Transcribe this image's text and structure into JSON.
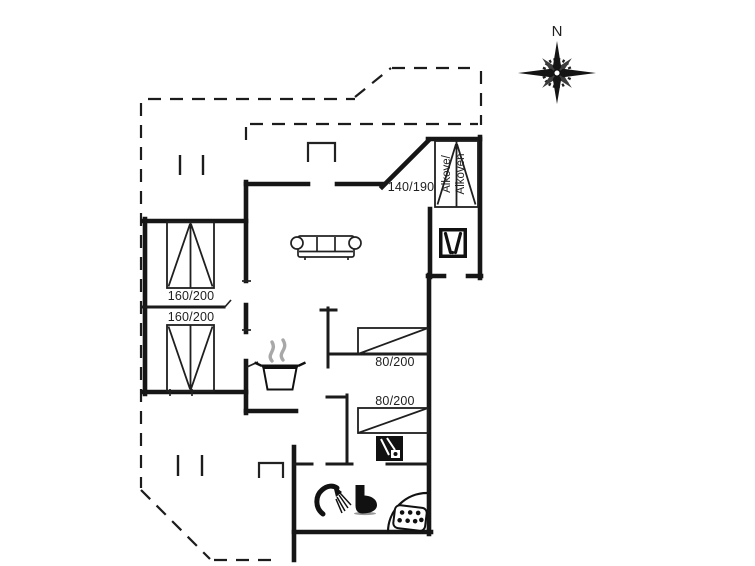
{
  "page": {
    "kind": "holiday-house floor plan drawing",
    "background": "#ffffff"
  },
  "compass": {
    "label": "N"
  },
  "rooms": {
    "bedroom_left_top": {
      "bed_label": "160/200"
    },
    "bedroom_left_bottom": {
      "bed_label": "160/200"
    },
    "alcove": {
      "bed_label": "140/190",
      "name_line1": "Alkove/",
      "name_line2": "Alkoven"
    },
    "bedroom_right_top": {
      "bed_label": "80/200"
    },
    "bedroom_right_bottom": {
      "bed_label": "80/200"
    }
  },
  "icons": {
    "compass": "compass-rose-icon",
    "sofa": "sofa-icon",
    "cooking_pot": "cooking-pot-steam-icon",
    "tv": "tv-icon",
    "appliance": "washing-machine-icon",
    "shower": "shower-icon",
    "toilet": "toilet-icon",
    "corner_sink": "corner-sink-icon"
  },
  "colors": {
    "wall": "#161616",
    "thin_line": "#2a2a2a",
    "steam": "#a8a8a8",
    "fixture": "#111111"
  }
}
